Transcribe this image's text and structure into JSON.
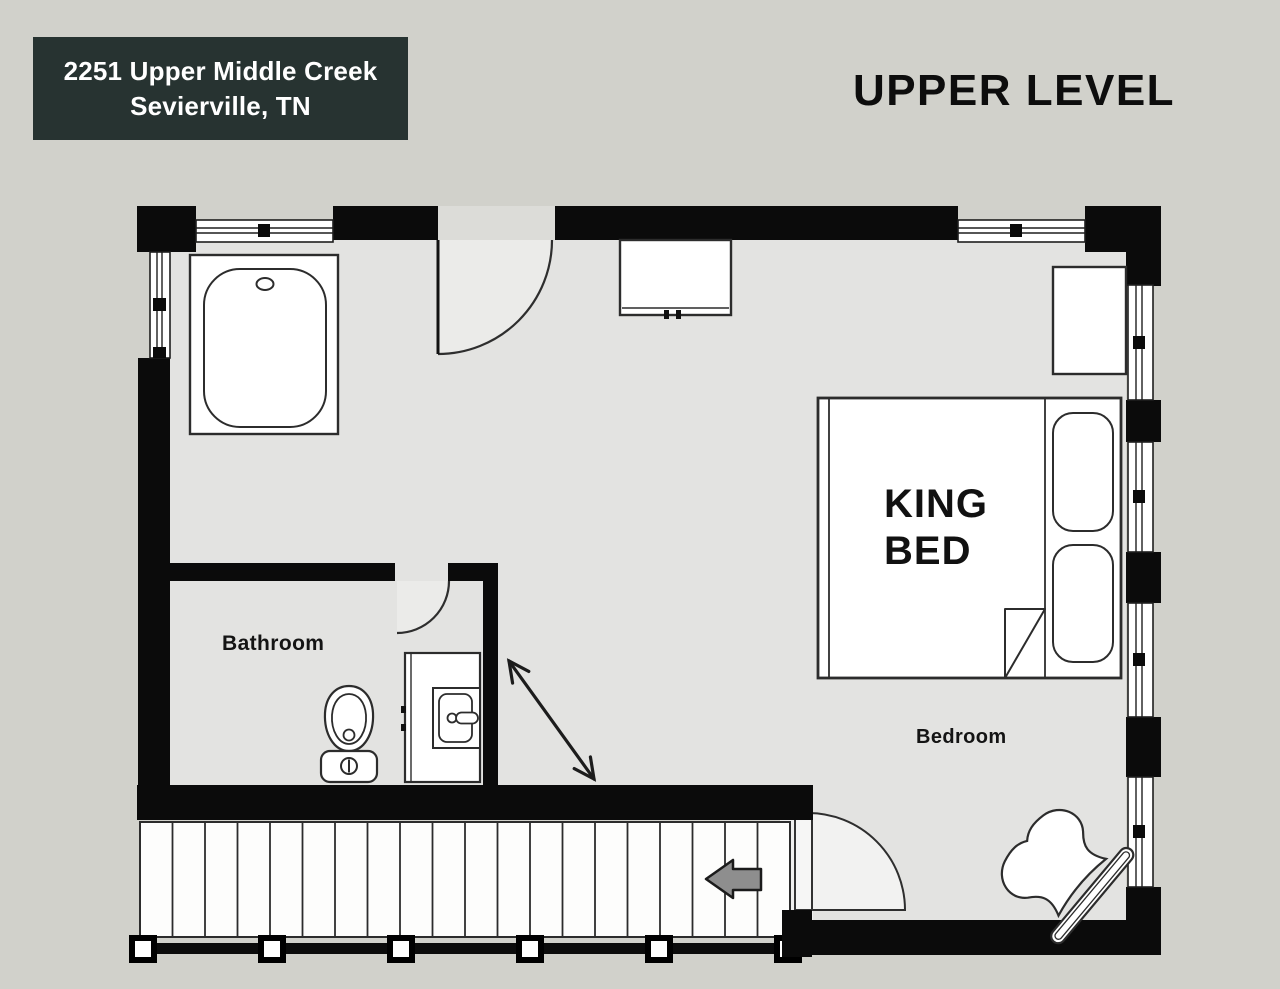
{
  "address_card": {
    "line1": "2251 Upper Middle Creek",
    "line2": "Sevierville, TN"
  },
  "plan_title": "UPPER LEVEL",
  "labels": {
    "bathroom": "Bathroom",
    "bedroom": "Bedroom",
    "king_bed": "KING BED"
  },
  "furniture": [
    "bathtub",
    "toilet",
    "vanity-sink",
    "dresser",
    "nightstand",
    "king-bed",
    "pillows",
    "armchair",
    "staircase",
    "railing",
    "stair-direction-arrow"
  ],
  "colors": {
    "background": "#d1d1cb",
    "floor": "#e3e3e1",
    "wall": "#0b0b0b",
    "furniture_fill": "#ffffff",
    "outline": "#2c2c2c",
    "address_card_bg": "#273331",
    "address_card_text": "#ffffff",
    "title_text": "#0d0d0d",
    "arrow_fill": "#8e8e8e"
  }
}
